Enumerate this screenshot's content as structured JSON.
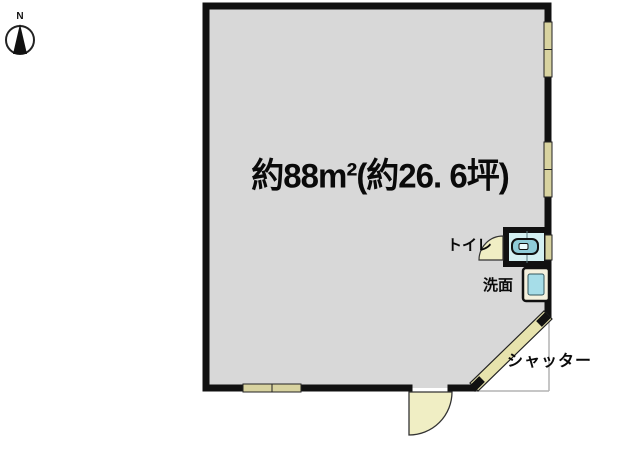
{
  "compass": {
    "north_label": "N"
  },
  "plan": {
    "area_label": "約88m²(約26. 6坪)",
    "toilet_label": "トイレ",
    "washbasin_label": "洗面",
    "shutter_label": "シャッター"
  },
  "colors": {
    "background": "#ffffff",
    "floor": "#d8d8d8",
    "wall": "#111111",
    "window": "#d8d3a0",
    "door": "#f0eec4",
    "shutter": "#e7e3ad",
    "toilet_floor": "#d4f0f2",
    "toilet_fixture": "#8fccd8",
    "washbasin_body": "#f4f1de",
    "washbasin_inner": "#a6dde8",
    "boundary_line": "#b3b3b3",
    "compass_needle": "#111111"
  }
}
